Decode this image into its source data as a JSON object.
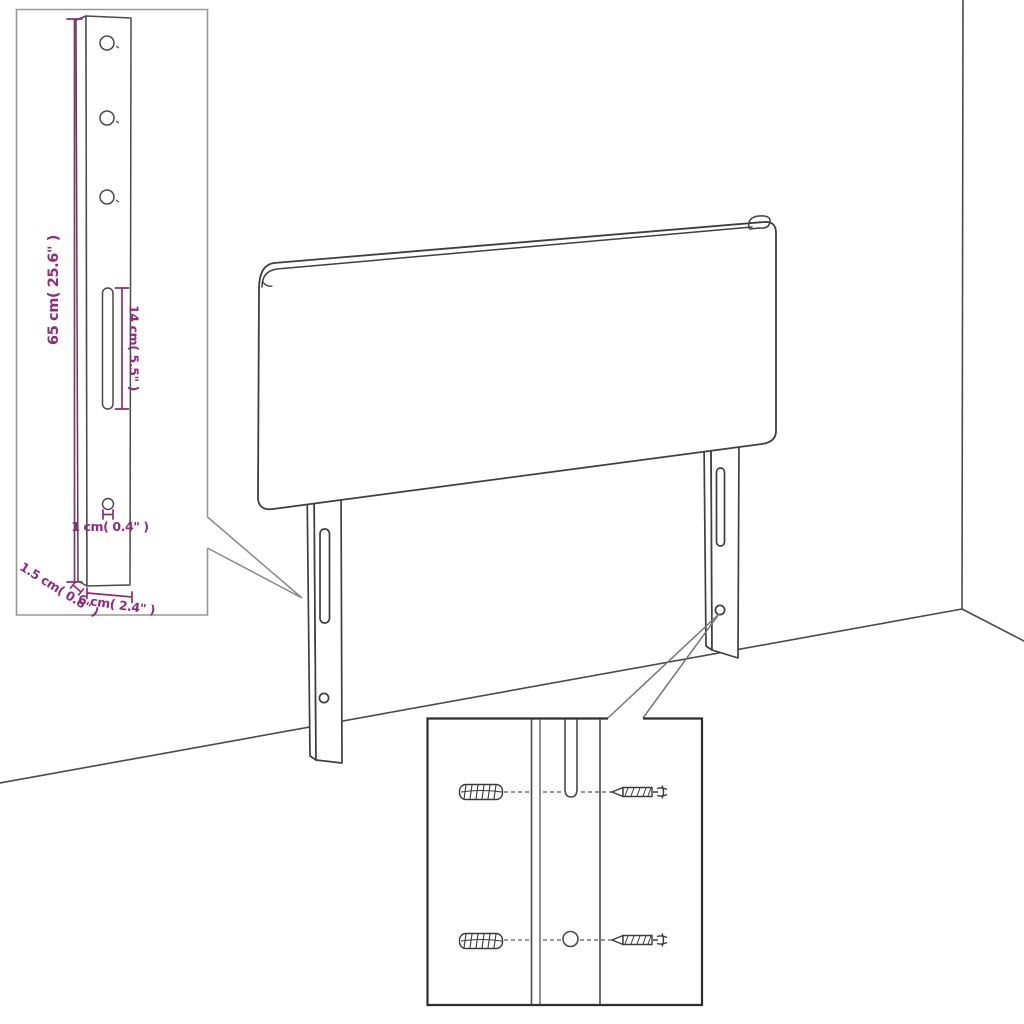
{
  "diagram": {
    "type": "furniture-assembly-diagram",
    "subject": "upholstered headboard with two wall-mount legs, room corner backdrop",
    "insets": {
      "leg_detail": {
        "description": "enlarged view of mounting leg with holes and slot",
        "dim_height": "65 cm( 25.6\" )",
        "dim_slot": "14 cm( 5.5\" )",
        "dim_hole": "1 cm( 0.4\" )",
        "dim_thickness": "1.5 cm( 0.6\" )",
        "dim_width": "6 cm( 2.4\" )"
      },
      "hardware_detail": {
        "description": "close-up of leg slot and hole with wall plugs and screws",
        "parts": [
          "wall-plug-top",
          "screw-top",
          "wall-plug-bottom",
          "screw-bottom"
        ]
      }
    },
    "colors": {
      "outline": "#3f3f3f",
      "dimension": "#8c2d7d",
      "inset_border_light": "#979797",
      "inset_border_dark": "#2e2e2e",
      "background": "#ffffff"
    }
  }
}
